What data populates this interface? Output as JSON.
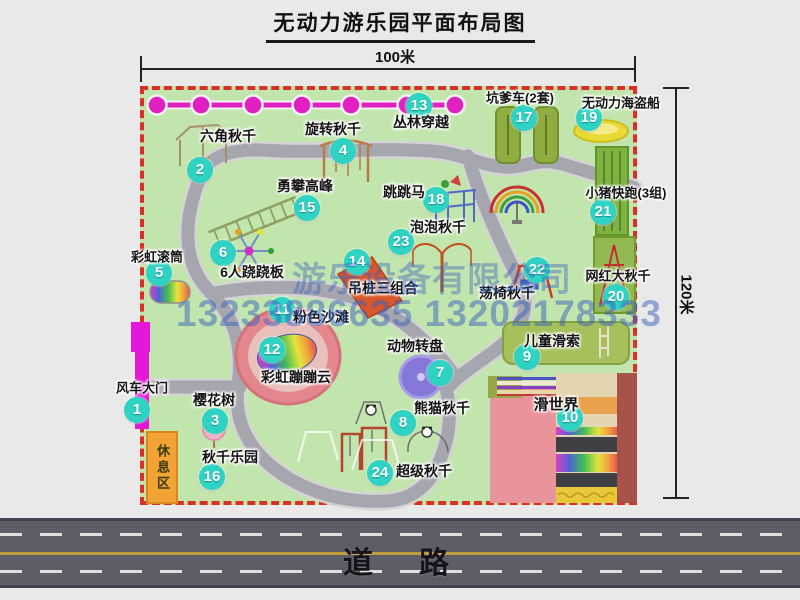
{
  "title": "无动力游乐园平面布局图",
  "dimensions": {
    "width_label": "100米",
    "height_label": "120米"
  },
  "road": {
    "label": "道　路"
  },
  "watermark": {
    "company": "游乐设备有限公司",
    "phone": "13233886635 13202178333"
  },
  "rest_area_label": "休息区",
  "colors": {
    "map_green": "#c2e5ad",
    "border_red": "#d83024",
    "badge_teal": "#2ed3c3",
    "gate_magenta": "#e318d8",
    "chain_magenta": "#e020c0",
    "path_gray": "#a6a6ae",
    "road_gray": "#5d5d66",
    "rest_orange": "#f2a335",
    "beach_pink": "#e4868e"
  },
  "attractions": [
    {
      "num": "1",
      "label": "风车大门",
      "bx": 137,
      "by": 410,
      "lx": 142,
      "ly": 387,
      "fs": 13
    },
    {
      "num": "2",
      "label": "六角秋千",
      "bx": 200,
      "by": 170,
      "lx": 228,
      "ly": 136
    },
    {
      "num": "3",
      "label": "樱花树",
      "bx": 215,
      "by": 421,
      "lx": 214,
      "ly": 400
    },
    {
      "num": "4",
      "label": "旋转秋千",
      "bx": 343,
      "by": 151,
      "lx": 333,
      "ly": 129
    },
    {
      "num": "5",
      "label": "彩虹滚筒",
      "bx": 159,
      "by": 273,
      "lx": 157,
      "ly": 256,
      "fs": 13
    },
    {
      "num": "6",
      "label": "6人跷跷板",
      "bx": 223,
      "by": 253,
      "lx": 252,
      "ly": 272
    },
    {
      "num": "7",
      "label": "动物转盘",
      "bx": 440,
      "by": 373,
      "lx": 415,
      "ly": 346
    },
    {
      "num": "8",
      "label": "熊猫秋千",
      "bx": 403,
      "by": 423,
      "lx": 442,
      "ly": 408
    },
    {
      "num": "9",
      "label": "儿童滑索",
      "bx": 527,
      "by": 357,
      "lx": 552,
      "ly": 341
    },
    {
      "num": "10",
      "label": "滑世界",
      "bx": 570,
      "by": 418,
      "lx": 556,
      "ly": 404,
      "fs": 15
    },
    {
      "num": "11",
      "label": "粉色沙滩",
      "bx": 282,
      "by": 310,
      "lx": 321,
      "ly": 317
    },
    {
      "num": "12",
      "label": "彩虹蹦蹦云",
      "bx": 272,
      "by": 350,
      "lx": 296,
      "ly": 377
    },
    {
      "num": "13",
      "label": "丛林穿越",
      "bx": 419,
      "by": 106,
      "lx": 421,
      "ly": 122
    },
    {
      "num": "14",
      "label": "吊桩三组合",
      "bx": 357,
      "by": 262,
      "lx": 383,
      "ly": 288
    },
    {
      "num": "15",
      "label": "勇攀高峰",
      "bx": 307,
      "by": 208,
      "lx": 305,
      "ly": 186
    },
    {
      "num": "16",
      "label": "秋千乐园",
      "bx": 212,
      "by": 477,
      "lx": 230,
      "ly": 457
    },
    {
      "num": "17",
      "label": "坑爹车(2套)",
      "bx": 524,
      "by": 118,
      "lx": 520,
      "ly": 97,
      "fs": 13
    },
    {
      "num": "18",
      "label": "跳跳马",
      "bx": 436,
      "by": 200,
      "lx": 404,
      "ly": 192
    },
    {
      "num": "19",
      "label": "无动力海盗船",
      "bx": 589,
      "by": 118,
      "lx": 621,
      "ly": 102,
      "fs": 13
    },
    {
      "num": "20",
      "label": "网红大秋千",
      "bx": 616,
      "by": 297,
      "lx": 618,
      "ly": 275,
      "fs": 13
    },
    {
      "num": "21",
      "label": "小猪快跑(3组)",
      "bx": 603,
      "by": 212,
      "lx": 626,
      "ly": 192,
      "fs": 13
    },
    {
      "num": "22",
      "label": "荡椅秋千",
      "bx": 537,
      "by": 270,
      "lx": 507,
      "ly": 293
    },
    {
      "num": "23",
      "label": "泡泡秋千",
      "bx": 401,
      "by": 242,
      "lx": 438,
      "ly": 227
    },
    {
      "num": "24",
      "label": "超级秋千",
      "bx": 380,
      "by": 473,
      "lx": 424,
      "ly": 471
    }
  ],
  "map_labels": [
    {
      "text": "彩虹秋千",
      "x": 539,
      "y": 226
    }
  ],
  "sub_labels": [
    {
      "text": "熊猫秋千1",
      "x": 343,
      "y": 412
    },
    {
      "text": "熊猫秋千2",
      "x": 441,
      "y": 449
    },
    {
      "text": "两个旋螺秋千",
      "x": 255,
      "y": 474
    },
    {
      "text": "两个发光秋千",
      "x": 255,
      "y": 486
    },
    {
      "text": "一个彩虹秋千",
      "x": 251,
      "y": 498
    }
  ],
  "path_labels": [
    {
      "text": "步道",
      "x": 273,
      "y": 148,
      "rot": -38
    },
    {
      "text": "步道",
      "x": 437,
      "y": 150,
      "rot": 5
    },
    {
      "text": "步道",
      "x": 549,
      "y": 161,
      "rot": 8
    },
    {
      "text": "步道",
      "x": 251,
      "y": 290,
      "rot": 5
    },
    {
      "text": "步道",
      "x": 466,
      "y": 320,
      "rot": 25
    },
    {
      "text": "步道",
      "x": 258,
      "y": 408,
      "rot": 72
    },
    {
      "text": "步道",
      "x": 385,
      "y": 500,
      "rot": -5
    }
  ]
}
